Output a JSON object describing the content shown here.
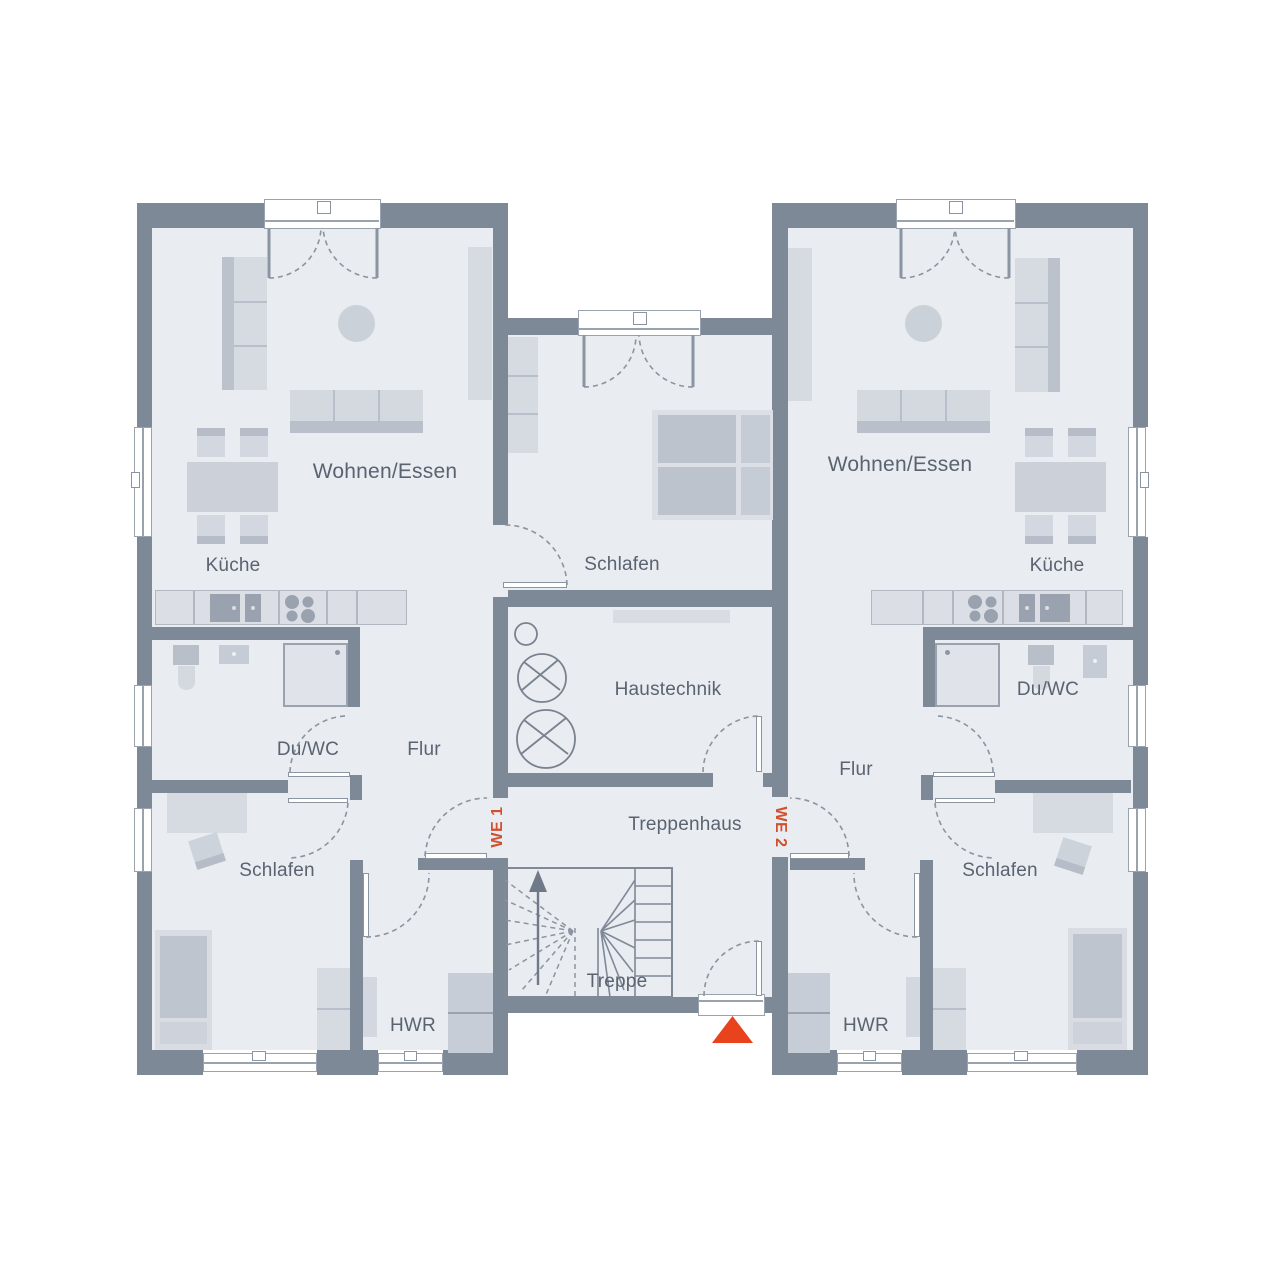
{
  "plan_type": "floor-plan",
  "units": {
    "we1": {
      "tag": "WE 1",
      "rooms": {
        "living": "Wohnen/Essen",
        "kitchen": "Küche",
        "bath": "Du/WC",
        "hall": "Flur",
        "bedroom": "Schlafen",
        "utility": "HWR"
      }
    },
    "we2": {
      "tag": "WE 2",
      "rooms": {
        "living": "Wohnen/Essen",
        "kitchen": "Küche",
        "bath": "Du/WC",
        "hall": "Flur",
        "bedroom": "Schlafen",
        "utility": "HWR"
      }
    }
  },
  "shared": {
    "bedroom": "Schlafen",
    "technical": "Haustechnik",
    "stairwell": "Treppenhaus",
    "stairs": "Treppe"
  },
  "colors": {
    "wall": "#7e8997",
    "floor": "#e9ecf1",
    "furniture_light": "#d6dae1",
    "furniture_dark": "#b9bfca",
    "appliance": "#99a2ae",
    "accent_text": "#d0512e",
    "entrance_marker": "#e8431d",
    "label_text": "#5a6370"
  }
}
